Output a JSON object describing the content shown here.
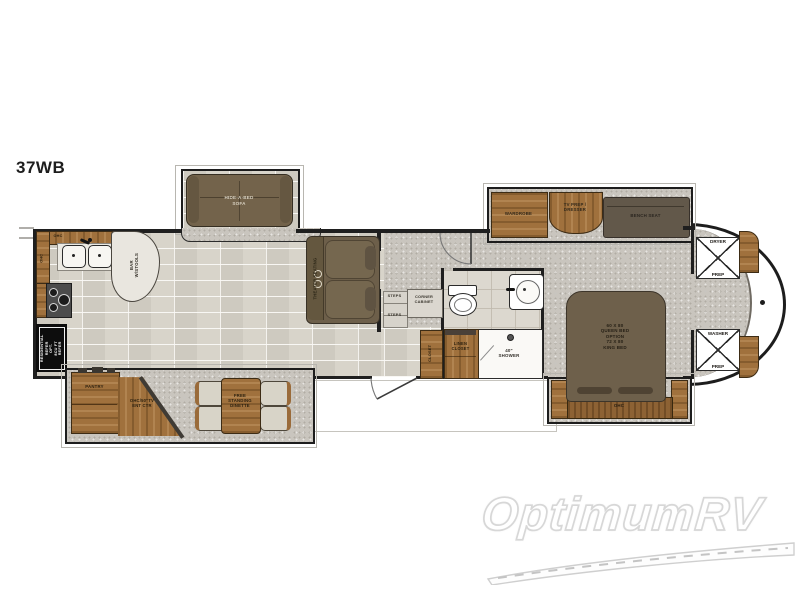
{
  "page": {
    "title": "37WB"
  },
  "watermark": {
    "brand": "OptimumRV"
  },
  "colors": {
    "wall": "#1f1f1f",
    "wood": "#a0713d",
    "dark_furniture": "#73634b",
    "plank_floor": "#d6d1c7",
    "carpet": "#c9c5be",
    "refrigerator": "#0d0d0d"
  },
  "labels": {
    "hide_a_bed": "HIDE-A-BED\nSOFA",
    "bar_stools": "BAR\nW/STOOLS",
    "ohc_counter_top": "OHC",
    "ohc_counter_left": "OHC",
    "refrigerator": "RESIDENTIAL\nREFER\nOPT.\n8CU FT\nREFER",
    "theater_seating": "THEATER SEATING",
    "steps_upper": "STEPS",
    "steps_lower": "STEPS",
    "corner_cabinet": "CORNER\nCABINET",
    "closet": "CLOSET",
    "linen_closet": "LINEN\nCLOSET",
    "shower": "40\"\nSHOWER",
    "pantry": "PANTRY",
    "entertainment_center": "OHC/50\"TV\nENT CTR",
    "dinette": "FREE\nSTANDING\nDINETTE",
    "wardrobe": "WARDROBE",
    "tv_prep_dresser": "TV PREP /\nDRESSER",
    "bench_seat": "BENCH SEAT",
    "dryer_prep_top": "DRYER",
    "dryer_prep_bottom": "PREP",
    "washer_prep_top": "WASHER",
    "washer_prep_bottom": "PREP",
    "bed": "60 X 80\nQUEEN BED\nOPTION\n72 X 80\nKING BED",
    "ohc_bed": "OHC"
  }
}
